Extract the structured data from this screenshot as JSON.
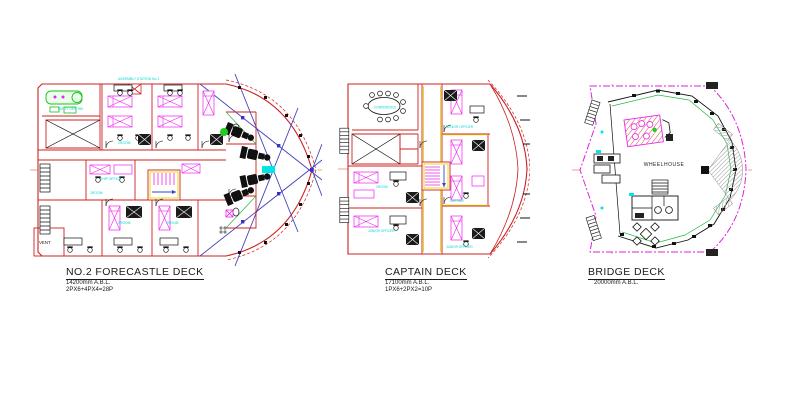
{
  "palette": {
    "wall_red": "#cc2222",
    "furniture_magenta": "#ee22ee",
    "label_cyan": "#00d6d6",
    "machinery_green": "#22bb22",
    "rigging_blue": "#4444bb",
    "boundary_magenta": "#dd22dd",
    "accent_yellow": "#e6d800",
    "ink_black": "#1a1a1a"
  },
  "decks": [
    {
      "title": "NO.2 FORECASTLE DECK",
      "elevation": "14200mm A.B.L.",
      "capacity": "2PX6+4PX4=28P",
      "rooms": {
        "assembly_station": "ASSEMBLY STATION No.1",
        "em_gen_rm": "EM'CY GEN RM",
        "ship_office": "SHIP OFFICE",
        "two_room": "2ROOM",
        "vent": "VENT"
      }
    },
    {
      "title": "CAPTAIN DECK",
      "elevation": "17100mm A.B.L.",
      "capacity": "1PX6+2PX2=10P",
      "rooms": {
        "conference": "CONFERENCE",
        "senior_officer": "SENIOR OFFICER",
        "captain": "CAPTAIN",
        "junior_officer": "JUNIOR OFFICER",
        "two_room": "2ROOM"
      }
    },
    {
      "title": "BRIDGE DECK",
      "elevation": "20000mm A.B.L.",
      "rooms": {
        "wheelhouse": "WHEELHOUSE"
      }
    }
  ]
}
